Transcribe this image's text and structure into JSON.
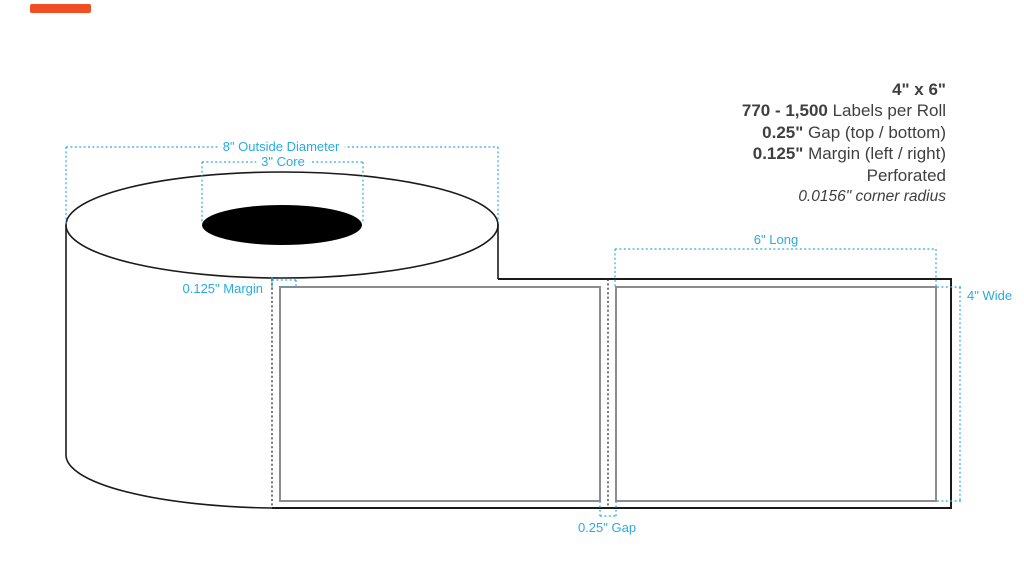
{
  "spec_panel": {
    "lines": [
      {
        "bold": "4\" x 6\"",
        "rest": ""
      },
      {
        "bold": "770 - 1,500",
        "rest": " Labels per Roll"
      },
      {
        "bold": "0.25\"",
        "rest": " Gap (top / bottom)"
      },
      {
        "bold": "0.125\"",
        "rest": " Margin (left / right)"
      },
      {
        "bold": "",
        "rest": "Perforated"
      },
      {
        "bold": "",
        "rest": "0.0156\" corner radius"
      }
    ]
  },
  "dimensions": {
    "outside_diameter": "8\" Outside Diameter",
    "core": "3\" Core",
    "margin": "0.125\" Margin",
    "long": "6\" Long",
    "wide": "4\" Wide",
    "gap": "0.25\" Gap"
  },
  "colors": {
    "annotation_blue": "#29ABE2",
    "spec_text_dark": "#3F3F3F",
    "label_outline_gray": "#8C8C8C",
    "line_black": "#1A1A1A",
    "accent_orange": "#F04E23",
    "core_fill": "#000000"
  }
}
